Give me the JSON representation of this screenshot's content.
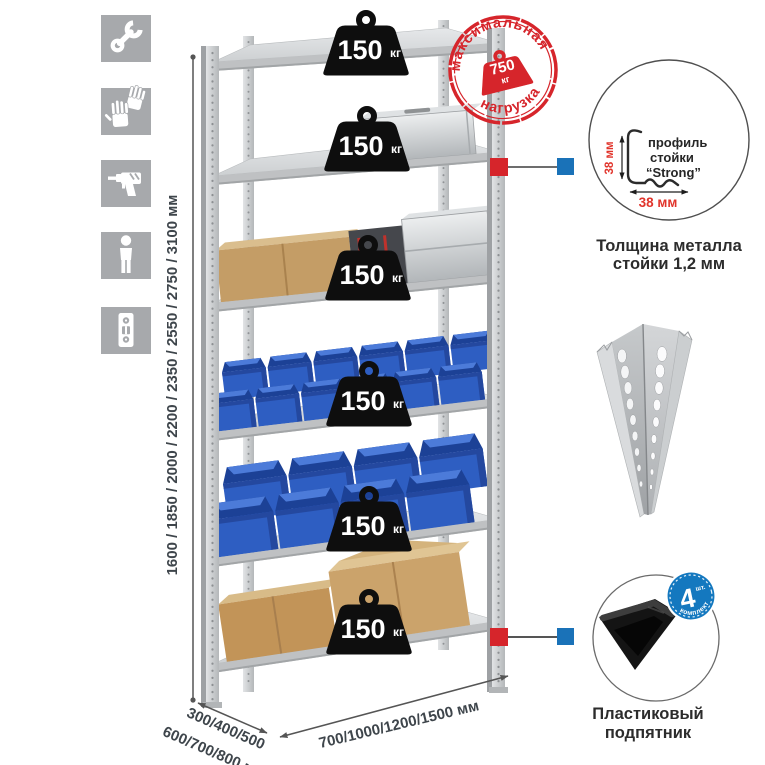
{
  "sidebar": {
    "icons": [
      {
        "name": "wrench"
      },
      {
        "name": "gloves"
      },
      {
        "name": "drill"
      },
      {
        "name": "person"
      },
      {
        "name": "level"
      }
    ]
  },
  "dimensions": {
    "height": "1600 / 1850 / 2000 / 2200 / 2350 / 2550 / 2750 / 3100 мм",
    "depth_line1": "300/400/500",
    "depth_line2": "600/700/800 мм",
    "width": "700/1000/1200/1500 мм"
  },
  "rack": {
    "shelves": [
      {
        "value": "150",
        "unit": "кг"
      },
      {
        "value": "150",
        "unit": "кг"
      },
      {
        "value": "150",
        "unit": "кг"
      },
      {
        "value": "150",
        "unit": "кг"
      },
      {
        "value": "150",
        "unit": "кг"
      },
      {
        "value": "150",
        "unit": "кг"
      }
    ]
  },
  "stamp": {
    "arc_top": "максимальная",
    "arc_bottom": "нагрузка",
    "value": "750",
    "unit": "кг"
  },
  "profile_callout": {
    "line1": "профиль",
    "line2": "стойки",
    "line3": "“Strong”",
    "dim_vertical": "38 мм",
    "dim_horizontal": "38 мм",
    "caption_line1": "Толщина металла",
    "caption_line2": "стойки 1,2 мм"
  },
  "foot_callout": {
    "badge_value": "4",
    "badge_small": "шт.",
    "badge_arc": "в комплекте",
    "caption_line1": "Пластиковый",
    "caption_line2": "подпятник"
  },
  "colors": {
    "accent_red": "#d6252b",
    "accent_blue": "#1a72b8",
    "icon_gray": "#a7a9ac",
    "bin_blue": "#2e5ec2",
    "text_dark": "#3e454b"
  }
}
